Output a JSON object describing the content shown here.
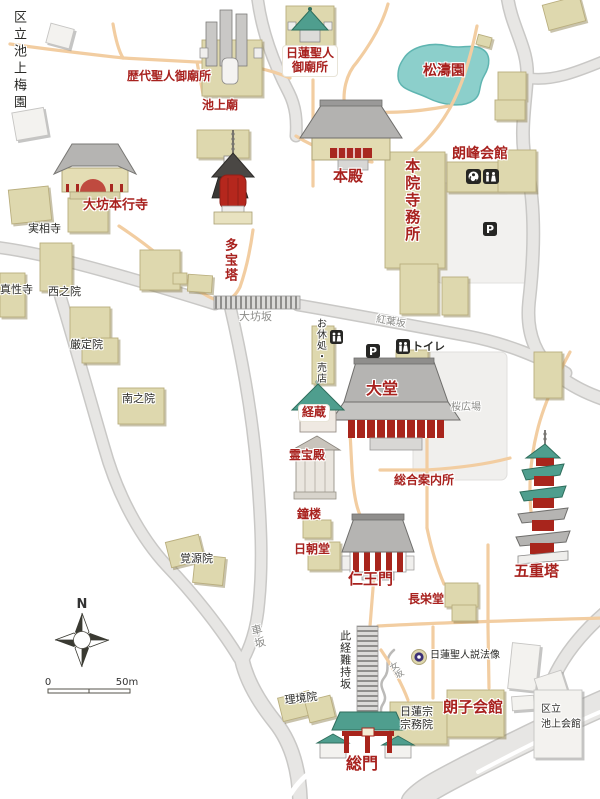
{
  "map_name": "temple-precinct-map",
  "legend": {
    "north": "N",
    "scale_start": "0",
    "scale_end": "50m"
  },
  "icons": {
    "parking": "P"
  },
  "colors": {
    "red_label": "#a8211e",
    "black_label": "#2b2b28",
    "gray_label": "#8b8b88",
    "building_tan": "#ded8ae",
    "building_white": "#f3f2ef",
    "roof_teal": "#4f9e8e",
    "roof_gray": "#b5b4b2",
    "structure_red": "#a8251c",
    "pond_teal": "#8ccfcb",
    "road_gray": "#e7e6e4",
    "path_orange": "#f2cda1"
  },
  "labels": {
    "ward_plum_garden": "区立池上梅園",
    "rekidai_mausoleum": "歴代聖人御廟所",
    "ikegami_byo": "池上廟",
    "nichiren_mausoleum_1": "日蓮聖人",
    "nichiren_mausoleum_2": "御廟所",
    "shotoen": "松濤園",
    "honden": "本殿",
    "honin_jimusho": "本院寺務所",
    "roho_kaikan": "朗峰会館",
    "daibo_hongyoji": "大坊本行寺",
    "jissoji": "実相寺",
    "shinshoji": "真性寺",
    "nishinoin": "西之院",
    "gonjoin": "厳定院",
    "minaminoin": "南之院",
    "tahoto": "多宝塔",
    "daibozaka": "大坊坂",
    "momijizaka": "紅葉坂",
    "oyasumidokoro": "お休処・売店",
    "toire": "トイレ",
    "daido": "大堂",
    "kyozo": "経蔵",
    "reihoden": "霊宝殿",
    "sakura_hiroba": "桜広場",
    "sogo_annaijo": "総合案内所",
    "shoro": "鐘楼",
    "nicchodo": "日朝堂",
    "niomon": "仁王門",
    "gojunoto": "五重塔",
    "choeido": "長栄堂",
    "kakugenin": "覚源院",
    "kurumazaka": "車坂",
    "shikyonanjizaka": "此経難持坂",
    "onnazaka": "女坂",
    "nichiren_seppozo": "日蓮聖人説法像",
    "rikyoin": "理境院",
    "shumuin_1": "日蓮宗",
    "shumuin_2": "宗務院",
    "roshi_kaikan": "朗子会館",
    "kuritsu_kaikan_1": "区立",
    "kuritsu_kaikan_2": "池上会館",
    "somon": "総門"
  }
}
